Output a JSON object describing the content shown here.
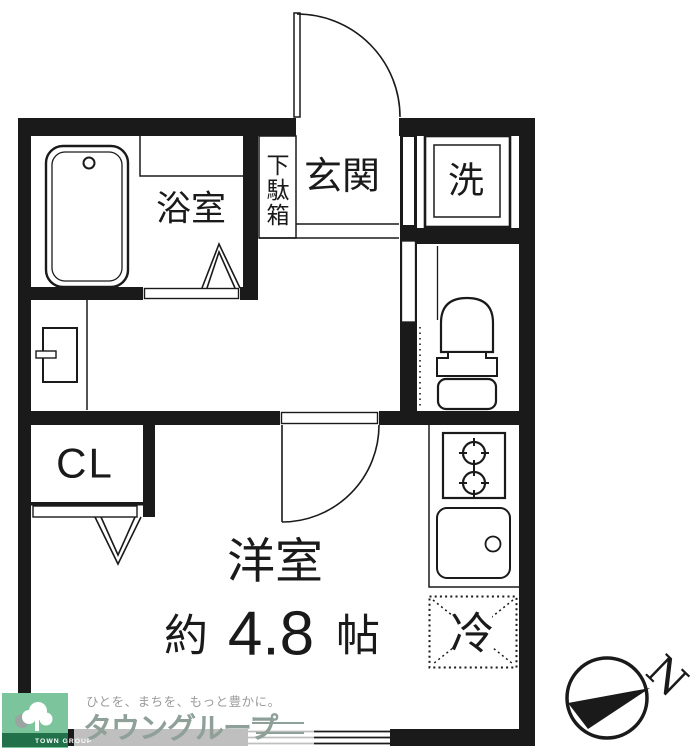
{
  "plan": {
    "labels": {
      "bathroom": "浴室",
      "shoe_chars": [
        "下",
        "駄",
        "箱"
      ],
      "entrance": "玄関",
      "washer": "洗",
      "closet": "CL",
      "room": "洋室",
      "size_prefix": "約",
      "size_value": "4.8",
      "size_unit": "帖",
      "fridge": "冷"
    },
    "compass": {
      "north_label": "N"
    },
    "colors": {
      "ink": "#1a1a1a",
      "logo_green": "#7cc49c",
      "logo_green_dark": "#21714b",
      "logo_gray": "#8fa099",
      "tagline_gray": "#9b9b9b"
    }
  },
  "watermark": {
    "tagline": "ひとを、まちを、もっと豊かに。",
    "brand": "タウングループ",
    "badge": "TOWN GROUP"
  }
}
